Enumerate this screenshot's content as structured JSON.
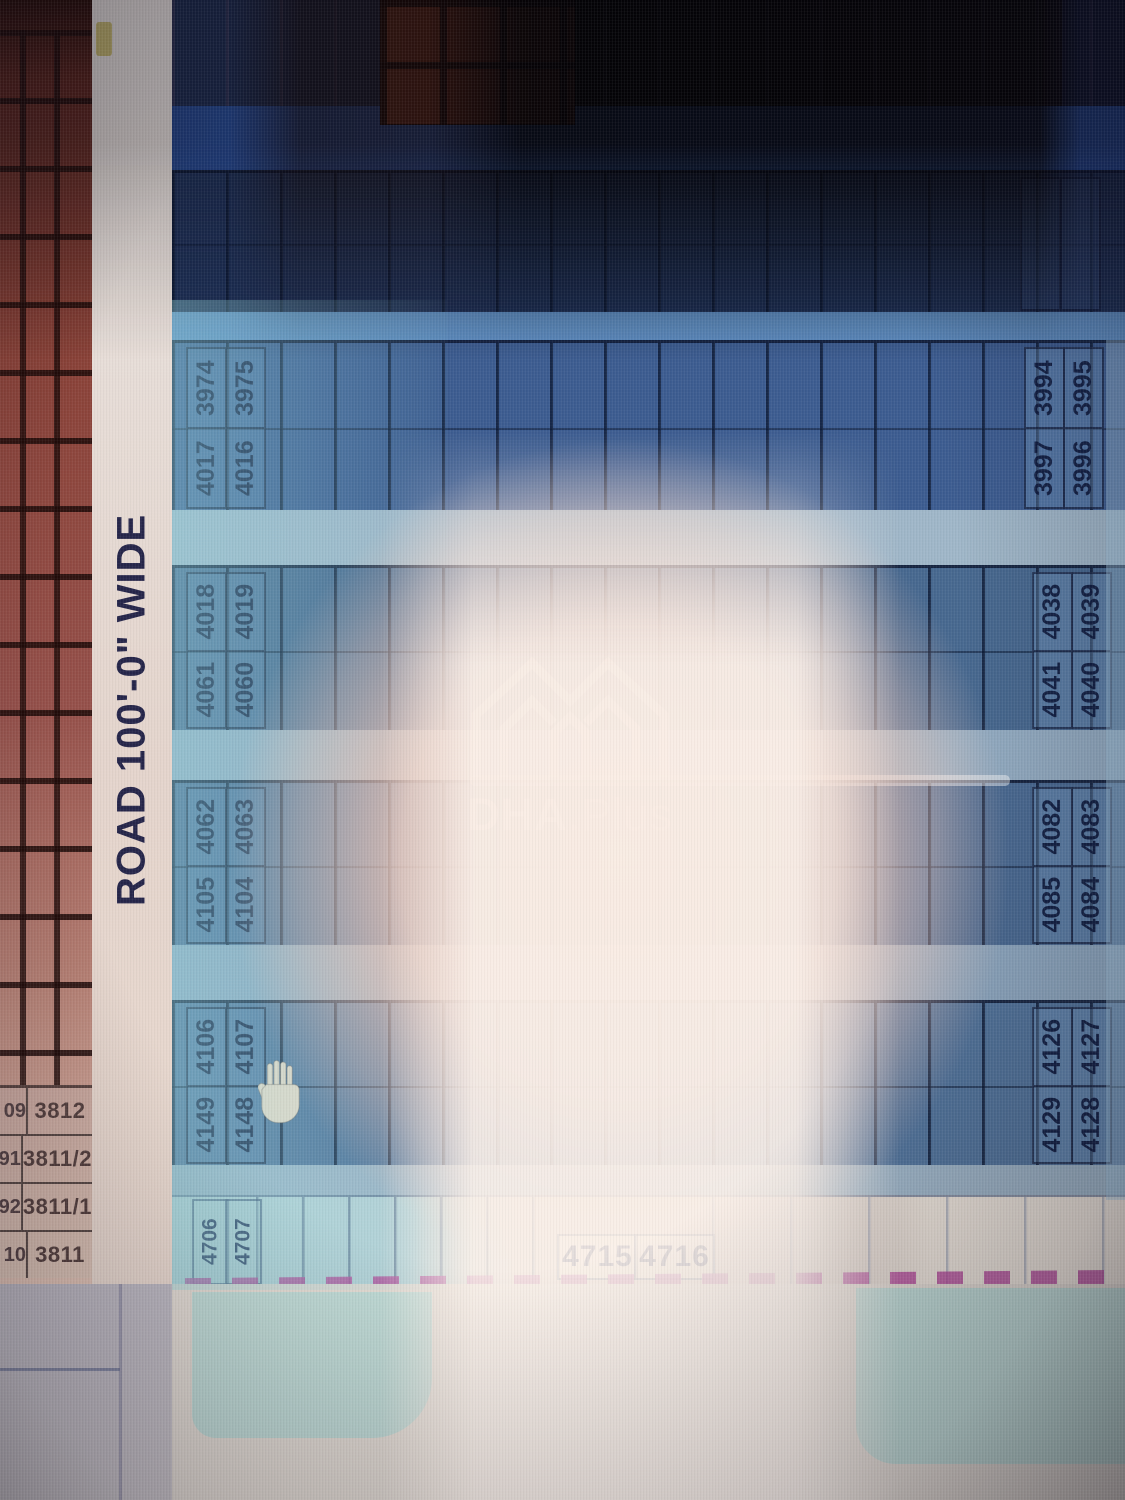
{
  "road_label": "ROAD 100'-0\" WIDE",
  "watermark": {
    "brand_bold": "DHA",
    "brand_light": ".Plus"
  },
  "left_sector": {
    "rows": [
      {
        "fragment": "09",
        "number": "3812"
      },
      {
        "fragment": "91",
        "number": "3811/2"
      },
      {
        "fragment": "92",
        "number": "3811/1"
      },
      {
        "fragment": "10",
        "number": "3811"
      }
    ]
  },
  "bands": [
    {
      "name": "plot-row-1",
      "left_labels": [
        [
          "4017",
          "3974"
        ],
        [
          "4016",
          "3975"
        ]
      ],
      "right_labels": [
        [
          "3997",
          "3994"
        ],
        [
          "3996",
          "3995"
        ]
      ]
    },
    {
      "name": "plot-row-2",
      "left_labels": [
        [
          "4061",
          "4018"
        ],
        [
          "4060",
          "4019"
        ]
      ],
      "right_labels": [
        [
          "4041",
          "4038"
        ],
        [
          "4040",
          "4039"
        ]
      ]
    },
    {
      "name": "plot-row-3",
      "left_labels": [
        [
          "4105",
          "4062"
        ],
        [
          "4104",
          "4063"
        ]
      ],
      "right_labels": [
        [
          "4085",
          "4082"
        ],
        [
          "4084",
          "4083"
        ]
      ]
    },
    {
      "name": "plot-row-4",
      "left_labels": [
        [
          "4149",
          "4106"
        ],
        [
          "4148",
          "4107"
        ]
      ],
      "right_labels": [
        [
          "4129",
          "4126"
        ],
        [
          "4128",
          "4127"
        ]
      ]
    }
  ],
  "bottom_row": {
    "vertical_labels": [
      "4706",
      "4707"
    ],
    "horizontal_labels": [
      "4715",
      "4716"
    ]
  }
}
